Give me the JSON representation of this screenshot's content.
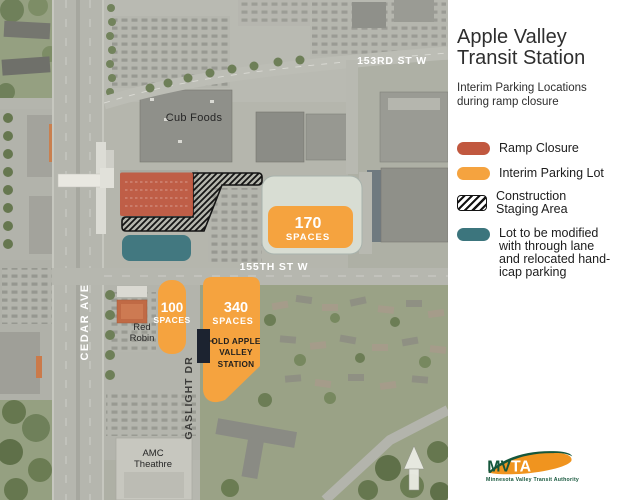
{
  "colors": {
    "ramp_closure": "#c1583f",
    "interim_parking": "#f5a33f",
    "modified_lot": "#3c757d",
    "staging_hatch": "#141414",
    "logo_orange": "#f0941f",
    "logo_green": "#15563b"
  },
  "panel": {
    "title": [
      "Apple Valley",
      "Transit Station"
    ],
    "subtitle": [
      "Interim Parking Locations",
      "during ramp closure"
    ],
    "legend": [
      {
        "label": "Ramp Closure"
      },
      {
        "label": "Interim Parking Lot"
      },
      {
        "lines": [
          "Construction",
          "Staging Area"
        ]
      },
      {
        "lines": [
          "Lot to be modified",
          "with through lane",
          "and relocated hand-",
          "icap parking"
        ]
      }
    ],
    "logo": {
      "acronym_left": "MV",
      "acronym_right": "TA",
      "tagline": "Minnesota Valley Transit Authority"
    }
  },
  "map": {
    "streets": {
      "s153": "153RD ST W",
      "s155": "155TH ST W",
      "cedar": "CEDAR AVE",
      "gaslight": "GASLIGHT DR"
    },
    "places": {
      "cub": "Cub Foods",
      "red_robin": [
        "Red",
        "Robin"
      ],
      "amc": [
        "AMC",
        "Theathre"
      ],
      "old_station": [
        "OLD APPLE",
        "VALLEY",
        "STATION"
      ]
    },
    "lots": {
      "l170": {
        "value": "170",
        "unit": "SPACES"
      },
      "l100": {
        "value": "100",
        "unit": "SPACES"
      },
      "l340": {
        "value": "340",
        "unit": "SPACES"
      }
    }
  }
}
